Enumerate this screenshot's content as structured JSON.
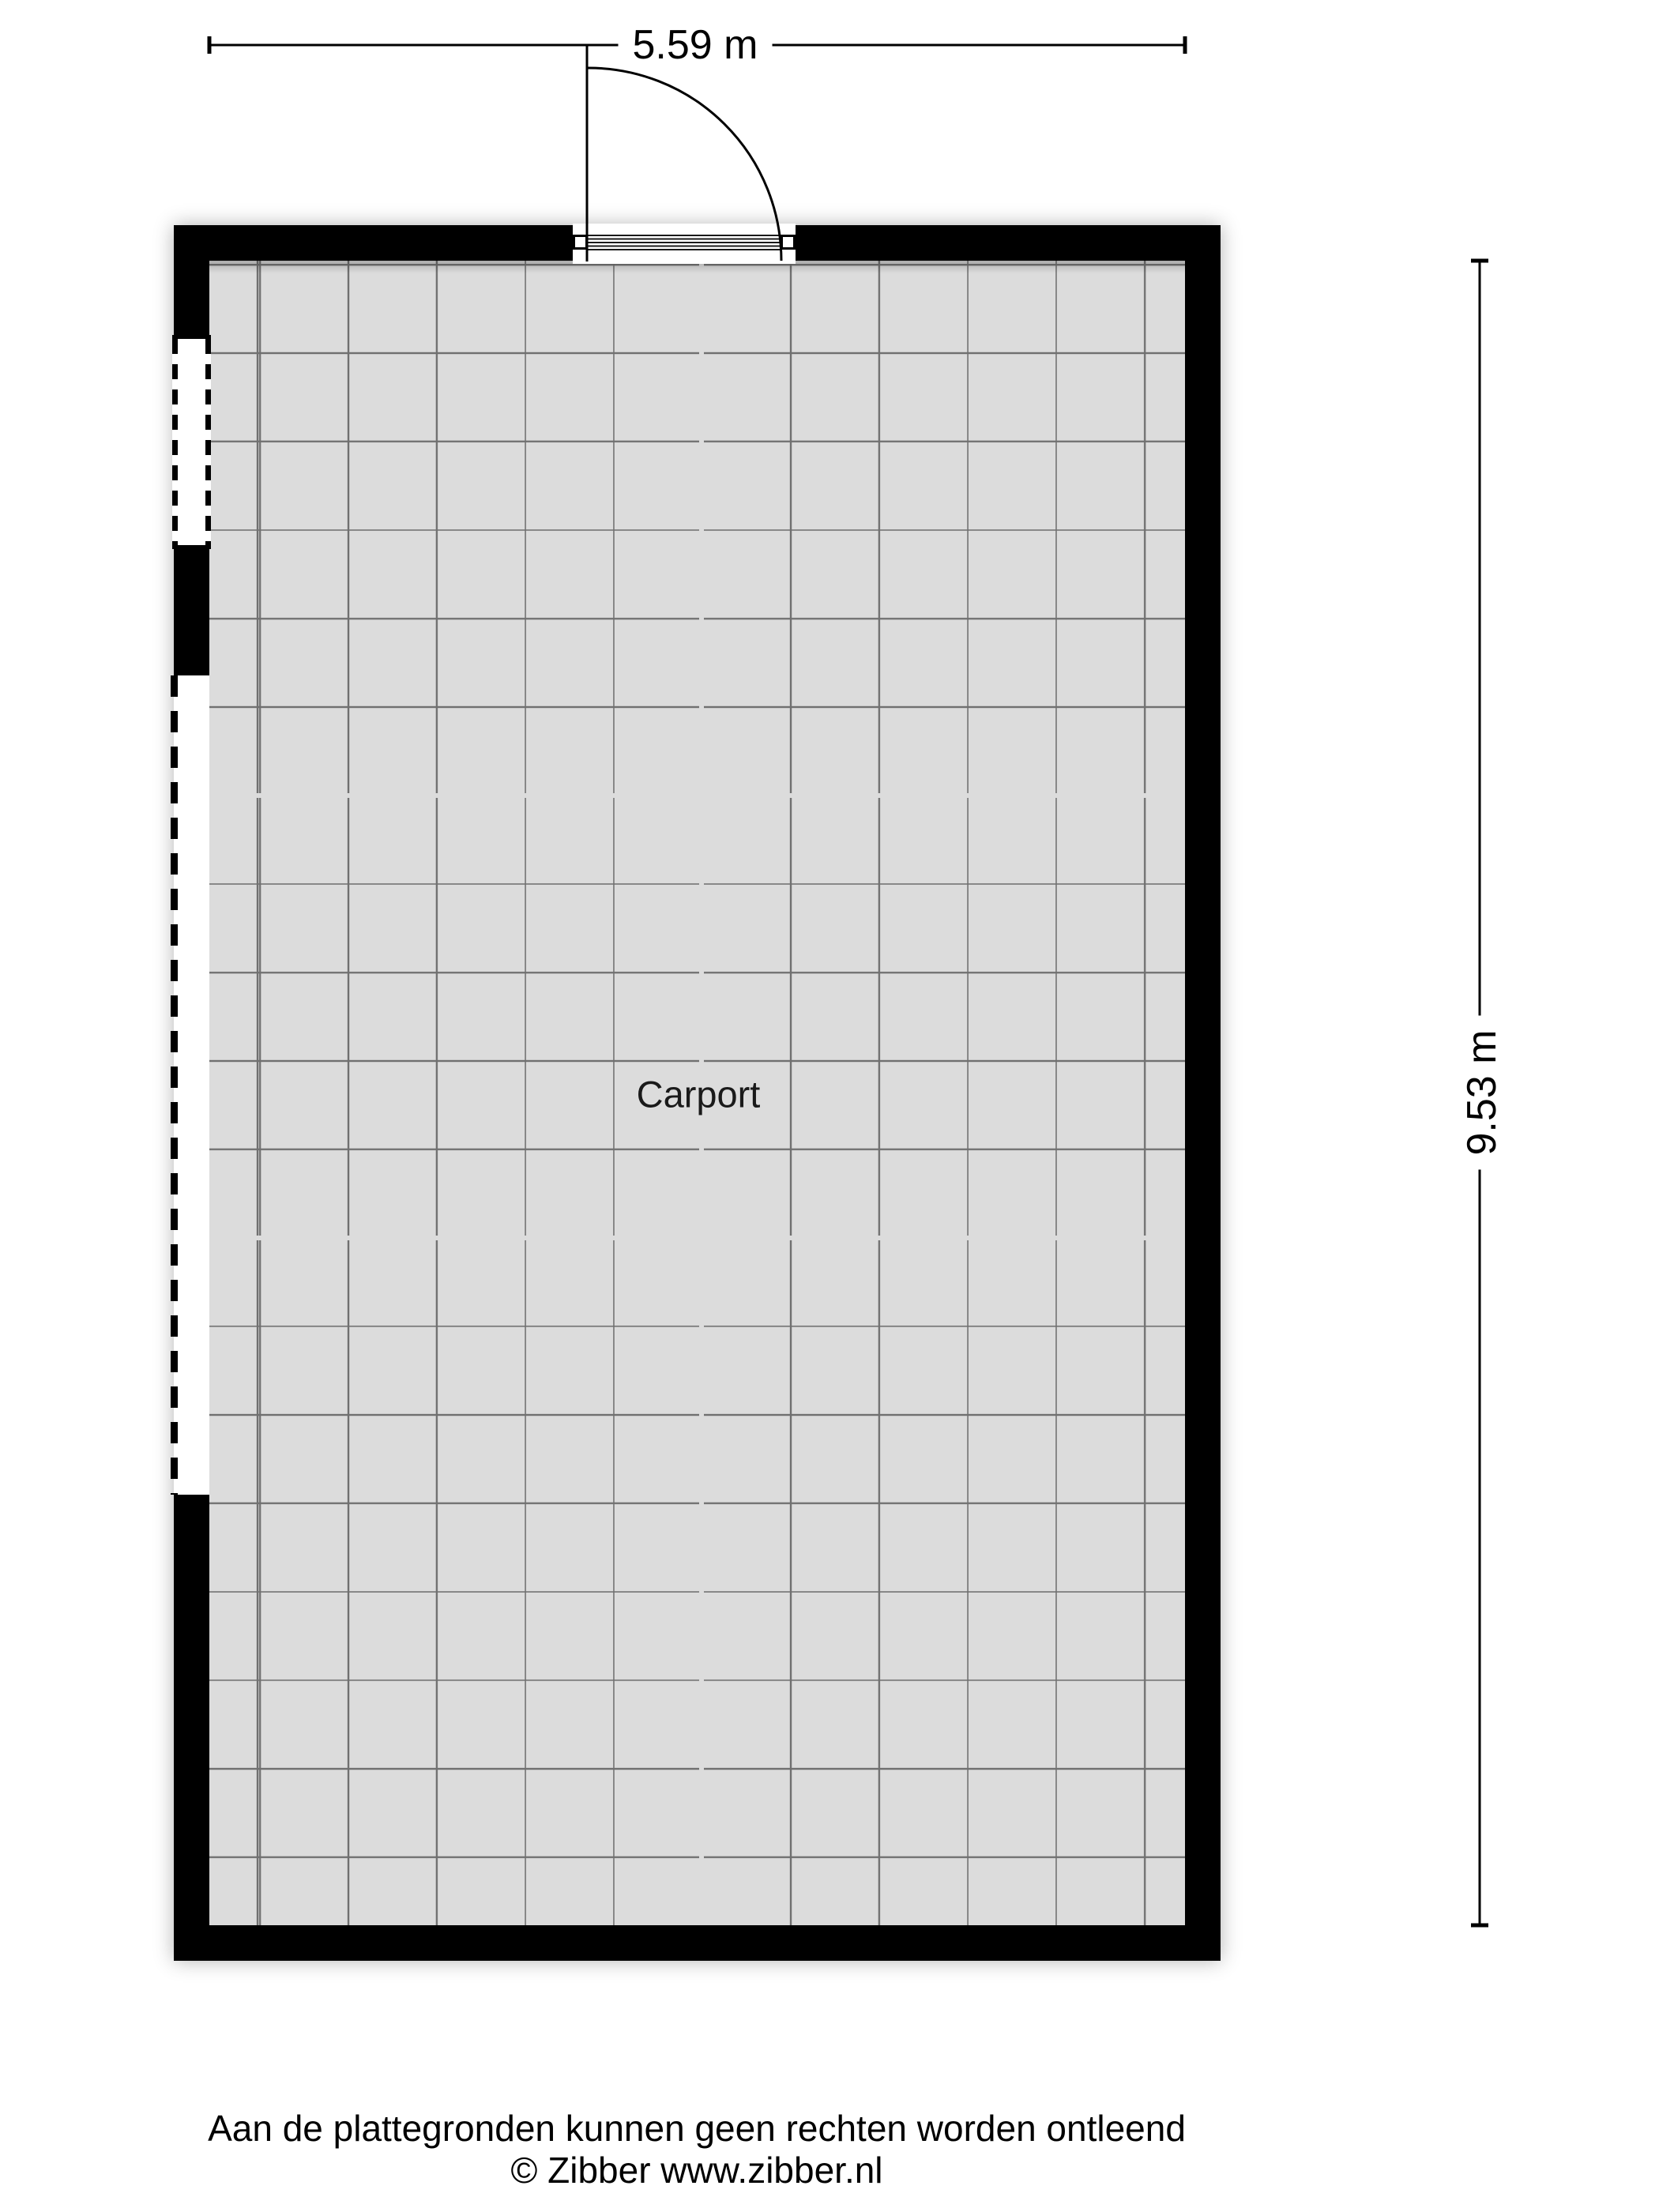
{
  "floorplan": {
    "room_label": "Carport",
    "dimensions": {
      "width_label": "5.59 m",
      "height_label": "9.53 m"
    }
  },
  "footer": {
    "disclaimer": "Aan de plattegronden kunnen geen rechten worden ontleend",
    "copyright": "© Zibber www.zibber.nl"
  },
  "colors": {
    "wall": "#000000",
    "floor": "#dcdcdc",
    "grid_line": "#707070",
    "text": "#000000",
    "background": "#ffffff"
  }
}
